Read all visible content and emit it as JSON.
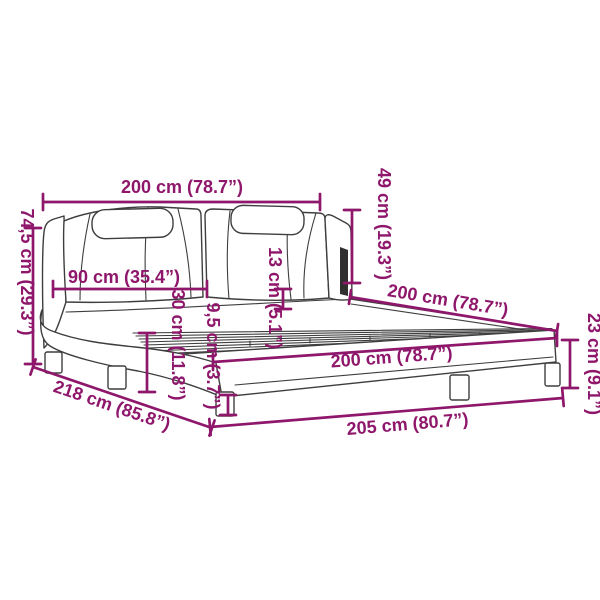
{
  "figure": {
    "kind": "product dimension diagram",
    "subject": "upholstered bed frame with curved side rails, two-cushion headboard and slatted base",
    "accent_color": "#8E176B",
    "line_color": "#3E3E3E",
    "strip_color": "#2F2F2F",
    "background": "#FFFFFF"
  },
  "dimensions": [
    {
      "id": "headboard-width",
      "label": "200 cm (78.7”)",
      "cm": "200",
      "inches": "78.7"
    },
    {
      "id": "headboard-height",
      "label": "49 cm (19.3”)",
      "cm": "49",
      "inches": "19.3"
    },
    {
      "id": "total-height",
      "label": "74,5 cm (29.3”)",
      "cm": "74,5",
      "inches": "29.3"
    },
    {
      "id": "cushion-width",
      "label": "90 cm (35.4”)",
      "cm": "90",
      "inches": "35.4"
    },
    {
      "id": "headrest-thickness",
      "label": "13 cm (5.1”)",
      "cm": "13",
      "inches": "5.1"
    },
    {
      "id": "side-rail-height",
      "label": "30 cm (11.8”)",
      "cm": "30",
      "inches": "11.8"
    },
    {
      "id": "frame-rail-thickness",
      "label": "9,5 cm (3.7”)",
      "cm": "9,5",
      "inches": "3.7"
    },
    {
      "id": "bed-width-back",
      "label": "200 cm (78.7”)",
      "cm": "200",
      "inches": "78.7"
    },
    {
      "id": "bed-width-front",
      "label": "200 cm (78.7”)",
      "cm": "200",
      "inches": "78.7"
    },
    {
      "id": "total-length",
      "label": "218 cm (85.8”)",
      "cm": "218",
      "inches": "85.8"
    },
    {
      "id": "frame-length",
      "label": "205 cm (80.7”)",
      "cm": "205",
      "inches": "80.7"
    },
    {
      "id": "leg-height",
      "label": "23 cm (9.1”)",
      "cm": "23",
      "inches": "9.1"
    }
  ]
}
